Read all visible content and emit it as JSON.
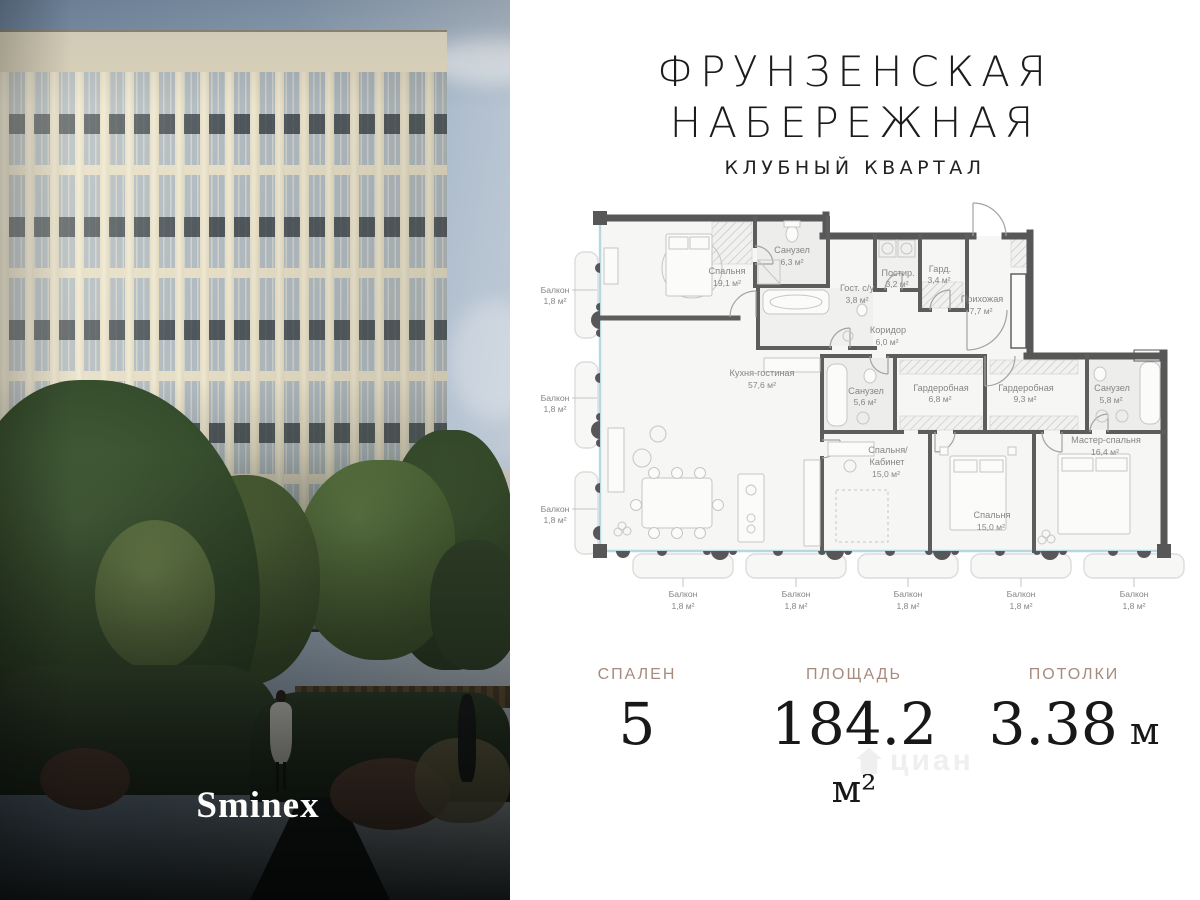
{
  "brand": {
    "title_line1": "ФРУНЗЕНСКАЯ",
    "title_line2": "НАБЕРЕЖНАЯ",
    "subtitle": "КЛУБНЫЙ КВАРТАЛ"
  },
  "developer_logo": "Sminex",
  "watermark": "циан",
  "stats": [
    {
      "label": "СПАЛЕН",
      "value": "5",
      "unit": ""
    },
    {
      "label": "ПЛОЩАДЬ",
      "value": "184.2",
      "unit": " м²"
    },
    {
      "label": "ПОТОЛКИ",
      "value": "3.38",
      "unit": " м"
    }
  ],
  "floorplan": {
    "rooms": [
      {
        "name": "Спальня",
        "area": "19,1 м²"
      },
      {
        "name": "Санузел",
        "area": "6,3 м²"
      },
      {
        "name": "Гост. с/у",
        "area": "3,8 м²"
      },
      {
        "name": "Постир.",
        "area": "3,2 м²"
      },
      {
        "name": "Гард.",
        "area": "3,4 м²"
      },
      {
        "name": "Прихожая",
        "area": "7,7 м²"
      },
      {
        "name": "Коридор",
        "area": "6,0 м²"
      },
      {
        "name": "Кухня-гостиная",
        "area": "57,6 м²"
      },
      {
        "name": "Санузел",
        "area": "5,6 м²"
      },
      {
        "name": "Гардеробная",
        "area": "6,8 м²"
      },
      {
        "name": "Гардеробная",
        "area": "9,3 м²"
      },
      {
        "name": "Санузел",
        "area": "5,8 м²"
      },
      {
        "name_line1": "Спальня/",
        "name_line2": "Кабинет",
        "area": "15,0 м²"
      },
      {
        "name": "Спальня",
        "area": "15,0 м²"
      },
      {
        "name": "Мастер-спальня",
        "area": "16,4 м²"
      }
    ],
    "balcony": {
      "label": "Балкон",
      "area": "1,8 м²",
      "left_count": 3,
      "bottom_count": 5
    }
  },
  "colors": {
    "wall": "#575757",
    "glazing": "#b7d8e0",
    "stat_label": "#a78b7e",
    "title": "#1c1c1c"
  }
}
